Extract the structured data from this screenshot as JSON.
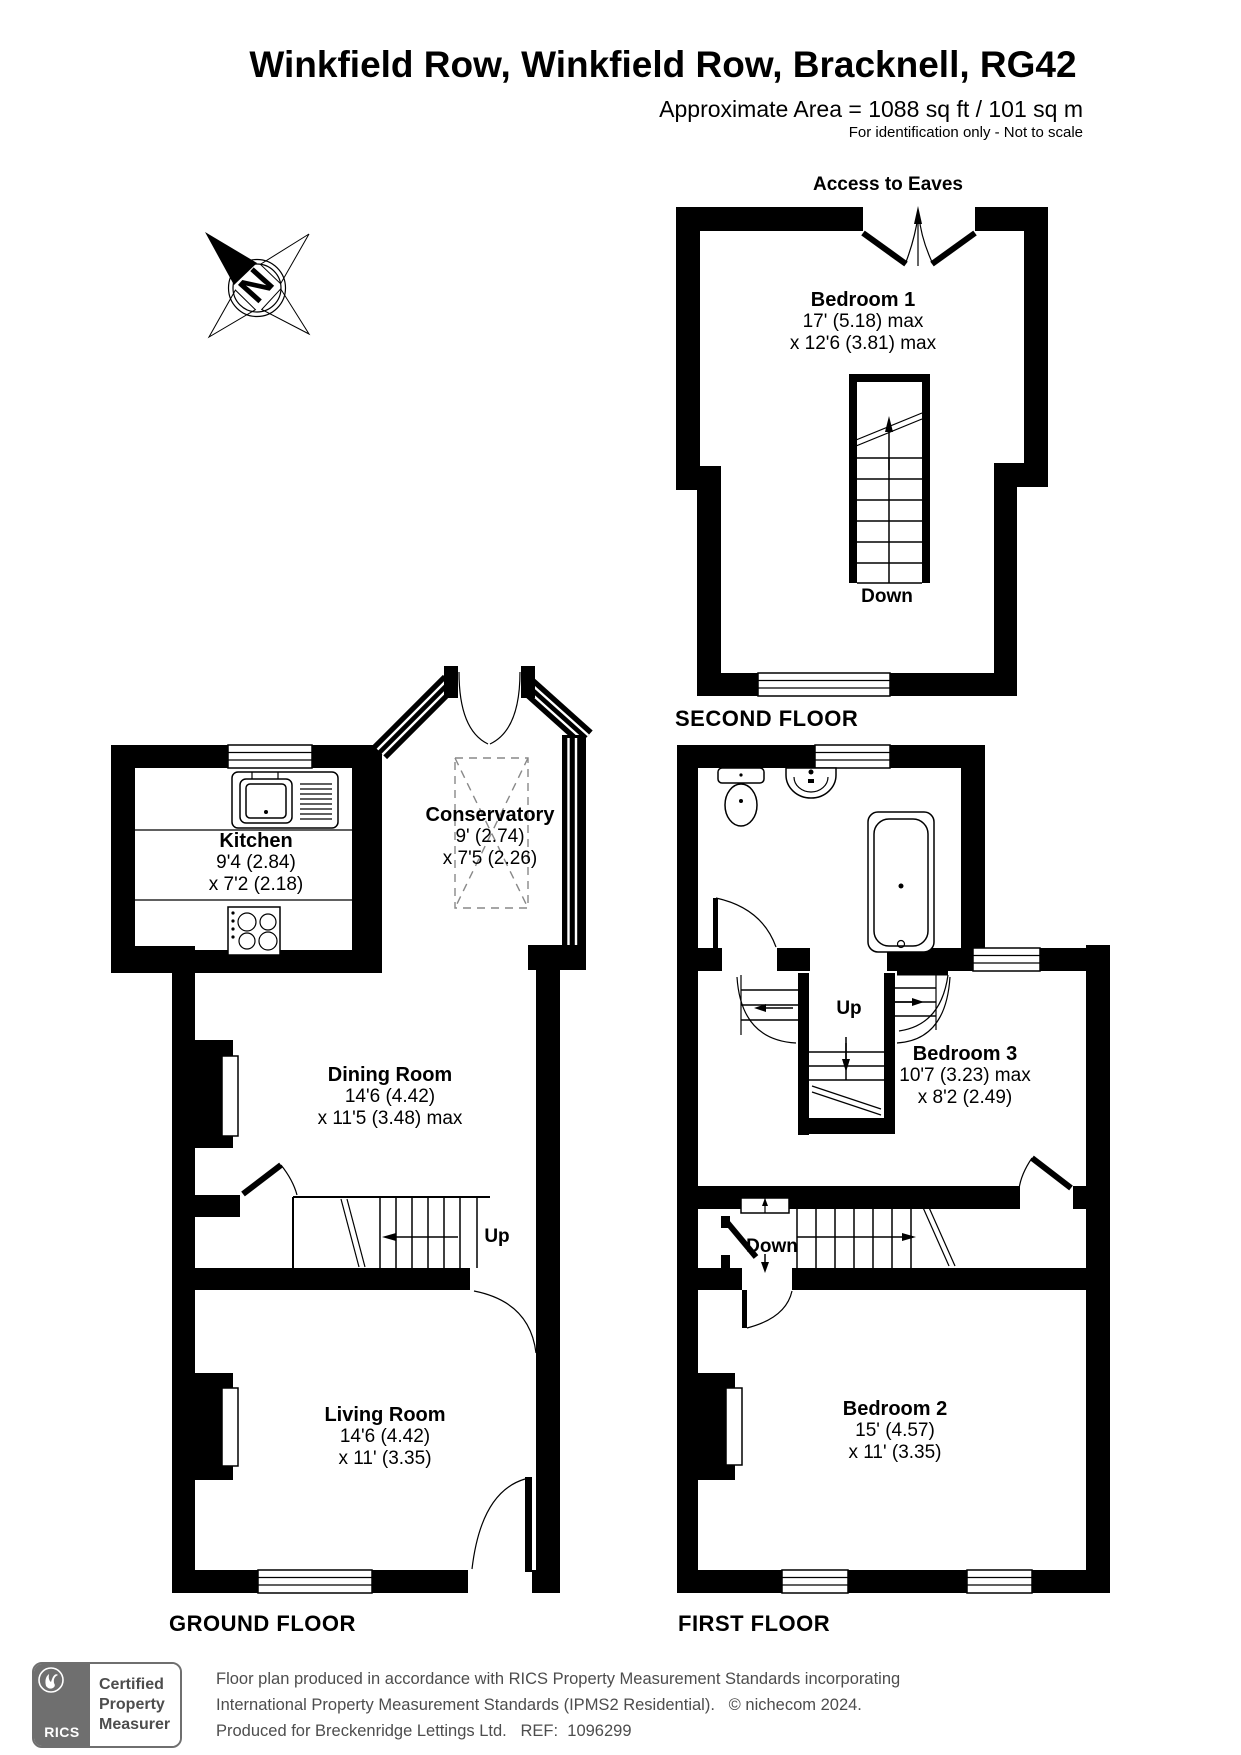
{
  "header": {
    "title": "Winkfield Row, Winkfield Row, Bracknell, RG42",
    "area": "Approximate Area = 1088 sq ft / 101 sq m",
    "note": "For identification only - Not to scale"
  },
  "compass": {
    "north": "N"
  },
  "second_floor": {
    "label": "SECOND FLOOR",
    "access_to_eaves": "Access to Eaves",
    "stairs_down": "Down",
    "bedroom1": {
      "name": "Bedroom 1",
      "dim1": "17' (5.18) max",
      "dim2": "x 12'6 (3.81) max"
    }
  },
  "ground_floor": {
    "label": "GROUND FLOOR",
    "stairs_up": "Up",
    "kitchen": {
      "name": "Kitchen",
      "dim1": "9'4 (2.84)",
      "dim2": "x 7'2 (2.18)"
    },
    "conservatory": {
      "name": "Conservatory",
      "dim1": "9' (2.74)",
      "dim2": "x 7'5 (2.26)"
    },
    "dining_room": {
      "name": "Dining Room",
      "dim1": "14'6 (4.42)",
      "dim2": "x 11'5 (3.48) max"
    },
    "living_room": {
      "name": "Living Room",
      "dim1": "14'6 (4.42)",
      "dim2": "x 11' (3.35)"
    }
  },
  "first_floor": {
    "label": "FIRST FLOOR",
    "stairs_up": "Up",
    "stairs_down": "Down",
    "bedroom3": {
      "name": "Bedroom 3",
      "dim1": "10'7 (3.23) max",
      "dim2": "x 8'2 (2.49)"
    },
    "bedroom2": {
      "name": "Bedroom 2",
      "dim1": "15' (4.57)",
      "dim2": "x 11' (3.35)"
    }
  },
  "footer": {
    "badge": {
      "org": "RICS",
      "line1": "Certified",
      "line2": "Property",
      "line3": "Measurer"
    },
    "line1": "Floor plan produced in accordance with RICS Property Measurement Standards incorporating",
    "line2": "International Property Measurement Standards (IPMS2 Residential).   © nichecom 2024.",
    "line3": "Produced for Breckenridge Lettings Ltd.   REF:  1096299"
  },
  "colors": {
    "wall": "#000000",
    "footer_text": "#4d4d4d",
    "badge_grey": "#6f6f6f"
  }
}
